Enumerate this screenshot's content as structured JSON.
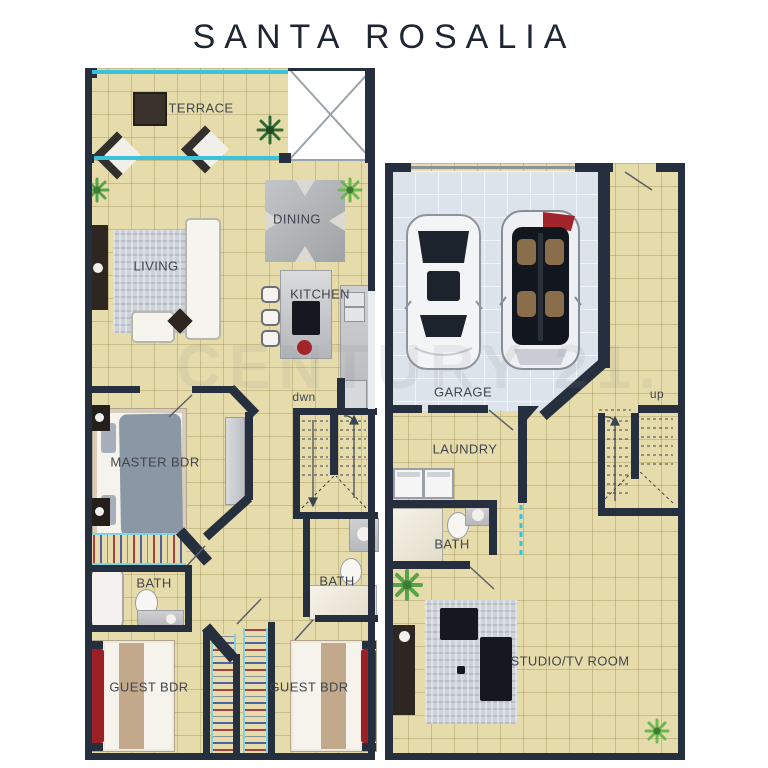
{
  "title": "SANTA ROSALIA",
  "watermark": "CENTURY 21.",
  "upper_floor": {
    "rooms": {
      "terrace": "TERRACE",
      "dining": "DINING",
      "living": "LIVING",
      "kitchen": "KITCHEN",
      "stairs": "dwn",
      "master_bedroom": "MASTER BDR",
      "bath_left": "BATH",
      "bath_right": "BATH",
      "guest_bedroom_left": "GUEST BDR",
      "guest_bedroom_right": "GUEST BDR"
    }
  },
  "lower_floor": {
    "rooms": {
      "garage": "GARAGE",
      "stairs": "up",
      "laundry": "LAUNDRY",
      "bath": "BATH",
      "studio": "STUDIO/TV ROOM"
    }
  },
  "colors": {
    "wall": "#262f3d",
    "floor": "#e6dcab",
    "floor_grid": "#d5c890",
    "garage_floor": "#dce3eb",
    "glass": "#3cc3da",
    "label_text": "#41454d",
    "title_text": "#1d2632",
    "accent_red": "#9c2026"
  }
}
